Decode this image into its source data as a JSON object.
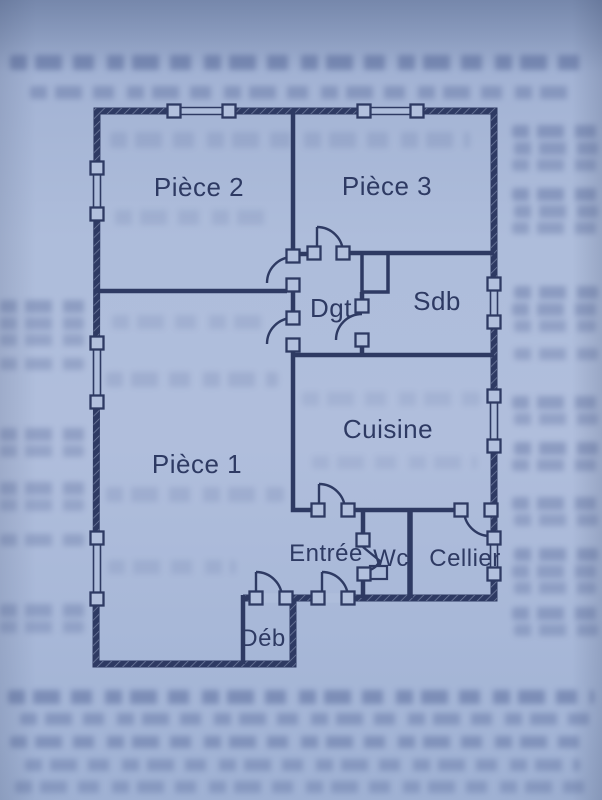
{
  "plan": {
    "kind": "apartment-floor-plan",
    "colors": {
      "ink": "#2e3a63",
      "paper": "#aebddb"
    },
    "rooms": [
      {
        "name": "Pièce 2"
      },
      {
        "name": "Pièce 3"
      },
      {
        "name": "Dgt"
      },
      {
        "name": "Sdb"
      },
      {
        "name": "Cuisine"
      },
      {
        "name": "Pièce 1"
      },
      {
        "name": "Entrée"
      },
      {
        "name": "Wc"
      },
      {
        "name": "Cellier"
      },
      {
        "name": "Déb"
      }
    ]
  }
}
